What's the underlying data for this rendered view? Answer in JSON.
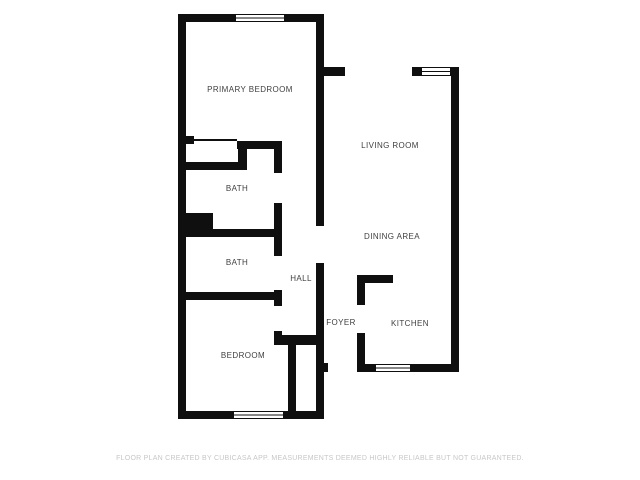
{
  "colors": {
    "wall": "#0f0f0f",
    "background": "#ffffff",
    "window_fill": "#ffffff",
    "label": "#3f3f3f",
    "footer": "#c7c7c7"
  },
  "footer": {
    "disclaimer": "FLOOR PLAN CREATED BY CUBICASA APP. MEASUREMENTS DEEMED HIGHLY RELIABLE BUT NOT GUARANTEED."
  },
  "floor_plan": {
    "label_font_size": 8,
    "rooms": [
      {
        "name": "primary-bedroom",
        "label": "PRIMARY BEDROOM",
        "label_x": 250,
        "label_y": 92
      },
      {
        "name": "living-room",
        "label": "LIVING ROOM",
        "label_x": 390,
        "label_y": 148
      },
      {
        "name": "bath-upper",
        "label": "BATH",
        "label_x": 237,
        "label_y": 191
      },
      {
        "name": "dining-area",
        "label": "DINING AREA",
        "label_x": 392,
        "label_y": 239
      },
      {
        "name": "bath-lower",
        "label": "BATH",
        "label_x": 237,
        "label_y": 265
      },
      {
        "name": "hall",
        "label": "HALL",
        "label_x": 301,
        "label_y": 281
      },
      {
        "name": "foyer",
        "label": "FOYER",
        "label_x": 341,
        "label_y": 325
      },
      {
        "name": "kitchen",
        "label": "KITCHEN",
        "label_x": 410,
        "label_y": 326
      },
      {
        "name": "bedroom",
        "label": "BEDROOM",
        "label_x": 243,
        "label_y": 358
      }
    ],
    "walls": [
      {
        "x": 178,
        "y": 14,
        "w": 57,
        "h": 8
      },
      {
        "x": 285,
        "y": 14,
        "w": 38,
        "h": 8
      },
      {
        "x": 178,
        "y": 14,
        "w": 8,
        "h": 405
      },
      {
        "x": 178,
        "y": 411,
        "w": 55,
        "h": 8
      },
      {
        "x": 284,
        "y": 411,
        "w": 39,
        "h": 8
      },
      {
        "x": 316,
        "y": 14,
        "w": 8,
        "h": 212
      },
      {
        "x": 324,
        "y": 67,
        "w": 21,
        "h": 9
      },
      {
        "x": 412,
        "y": 67,
        "w": 9,
        "h": 9
      },
      {
        "x": 451,
        "y": 67,
        "w": 8,
        "h": 9
      },
      {
        "x": 451,
        "y": 67,
        "w": 8,
        "h": 305
      },
      {
        "x": 357,
        "y": 364,
        "w": 18,
        "h": 8
      },
      {
        "x": 411,
        "y": 364,
        "w": 48,
        "h": 8
      },
      {
        "x": 186,
        "y": 136,
        "w": 8,
        "h": 8
      },
      {
        "x": 237,
        "y": 141,
        "w": 45,
        "h": 8
      },
      {
        "x": 238,
        "y": 141,
        "w": 9,
        "h": 29
      },
      {
        "x": 178,
        "y": 162,
        "w": 69,
        "h": 8
      },
      {
        "x": 274,
        "y": 141,
        "w": 8,
        "h": 32
      },
      {
        "x": 274,
        "y": 203,
        "w": 8,
        "h": 34
      },
      {
        "x": 178,
        "y": 229,
        "w": 104,
        "h": 8
      },
      {
        "x": 178,
        "y": 213,
        "w": 35,
        "h": 21
      },
      {
        "x": 274,
        "y": 237,
        "w": 8,
        "h": 19
      },
      {
        "x": 274,
        "y": 290,
        "w": 8,
        "h": 16
      },
      {
        "x": 178,
        "y": 292,
        "w": 104,
        "h": 8
      },
      {
        "x": 274,
        "y": 331,
        "w": 8,
        "h": 14
      },
      {
        "x": 274,
        "y": 335,
        "w": 49,
        "h": 10
      },
      {
        "x": 288,
        "y": 345,
        "w": 8,
        "h": 66
      },
      {
        "x": 316,
        "y": 263,
        "w": 8,
        "h": 156
      },
      {
        "x": 323,
        "y": 363,
        "w": 5,
        "h": 9
      },
      {
        "x": 357,
        "y": 275,
        "w": 8,
        "h": 30
      },
      {
        "x": 357,
        "y": 275,
        "w": 36,
        "h": 8
      },
      {
        "x": 357,
        "y": 333,
        "w": 8,
        "h": 39
      }
    ],
    "windows": [
      {
        "name": "primary-bedroom",
        "x": 235,
        "y": 14,
        "w": 50,
        "h": 8
      },
      {
        "name": "living-room",
        "x": 421,
        "y": 67,
        "w": 30,
        "h": 9
      },
      {
        "name": "kitchen",
        "x": 375,
        "y": 364,
        "w": 36,
        "h": 8
      },
      {
        "name": "bedroom",
        "x": 233,
        "y": 411,
        "w": 51,
        "h": 8
      }
    ],
    "thin_lines": [
      {
        "name": "closet-sliding-door",
        "x": 194,
        "y": 139,
        "w": 43,
        "h": 2
      }
    ],
    "openings": [
      {
        "name": "primary-bedroom-doorway",
        "x": 282,
        "y": 141,
        "w": 34,
        "h": 8
      },
      {
        "name": "bath-upper-door",
        "x": 274,
        "y": 173,
        "w": 8,
        "h": 30
      },
      {
        "name": "bath-lower-door",
        "x": 274,
        "y": 256,
        "w": 8,
        "h": 34
      },
      {
        "name": "bedroom-door",
        "x": 274,
        "y": 306,
        "w": 8,
        "h": 25
      },
      {
        "name": "hall-dining-opening",
        "x": 316,
        "y": 226,
        "w": 8,
        "h": 37
      },
      {
        "name": "living-room-top-opening",
        "x": 345,
        "y": 67,
        "w": 67,
        "h": 9
      },
      {
        "name": "kitchen-opening",
        "x": 357,
        "y": 305,
        "w": 8,
        "h": 28
      },
      {
        "name": "entry-door",
        "x": 328,
        "y": 363,
        "w": 29,
        "h": 9
      }
    ]
  }
}
